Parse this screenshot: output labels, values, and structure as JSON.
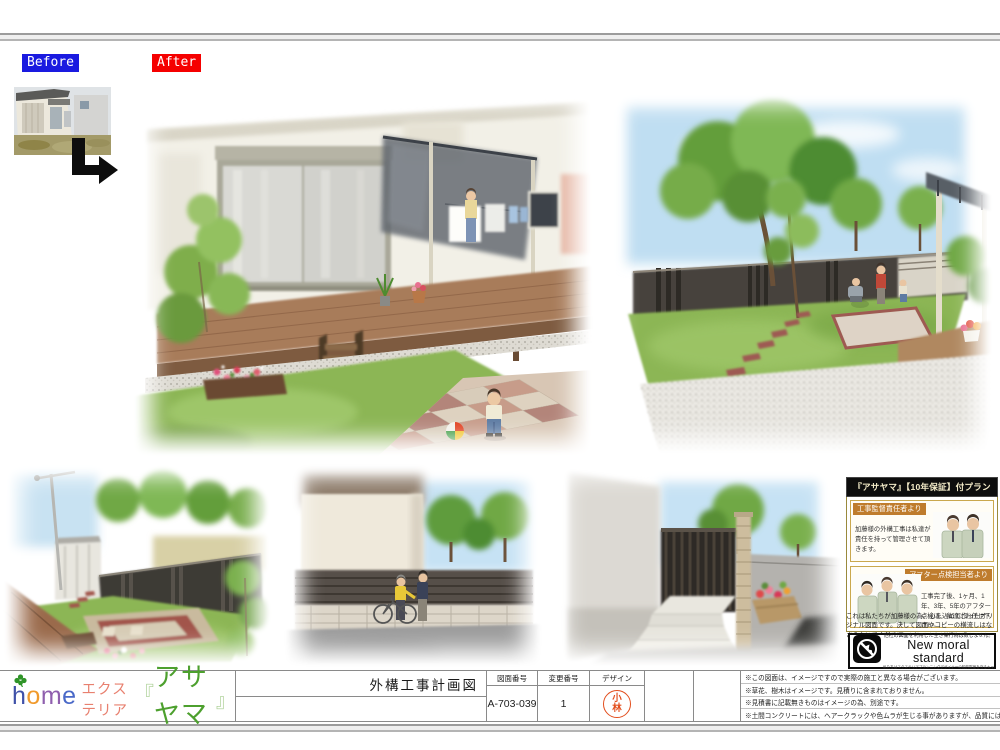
{
  "page": {
    "before_label": "Before",
    "after_label": "After"
  },
  "title_block": {
    "logo": {
      "h": "h",
      "o": "o",
      "m": "m",
      "e": "e",
      "exterior": "エクステリア",
      "quote_open": "『",
      "brand": "アサヤマ",
      "quote_close": "』"
    },
    "title": "外構工事計画図",
    "drawing_no_label": "図面番号",
    "drawing_no": "A-703-039",
    "change_no_label": "変更番号",
    "change_no": "1",
    "design_label": "デザイン",
    "design_stamp": "小林",
    "notes": [
      "※この図面は、イメージですので実際の施工と異なる場合がございます。",
      "※草花、樹木はイメージです。見積りに含まれておりません。",
      "※見積書に記載無きものはイメージの為、別途です。",
      "※土間コンクリートには、ヘアークラックや色ムラが生じる事がありますが、品質には問題ありません。"
    ]
  },
  "guarantee_panel": {
    "header": "『アサヤマ』【10年保証】付プラン",
    "section1": {
      "label": "工事監督責任者より",
      "text": "加藤様の外構工事は私達が責任を持って管理させて頂きます。"
    },
    "section2": {
      "label": "アフター点検担当者より",
      "text": "工事完了後、1ヶ月、1年、3年、5年のアフター点検は、私達にお任せ下さい。"
    },
    "original_note": "これは私たちが加藤様の為、心を込めて作ったオリジナル図面です。決して図面やコピーの横流しはなさらないでください。",
    "moral_box": {
      "small_top": "他社の図面を利用した空き巣行為は致しません。",
      "main": "New moral standard",
      "small_bottom": "私たちはエクステリアプランニングデザイナーの知的財産を守るキャンペーンに賛同しています。"
    }
  },
  "colors": {
    "before_bg": "#1a1ae0",
    "after_bg": "#f50000",
    "stamp_red": "#e24d1c",
    "panel_gold": "#caa84e",
    "label_orange": "#bf7c2d",
    "brand_green": "#4da02e"
  }
}
